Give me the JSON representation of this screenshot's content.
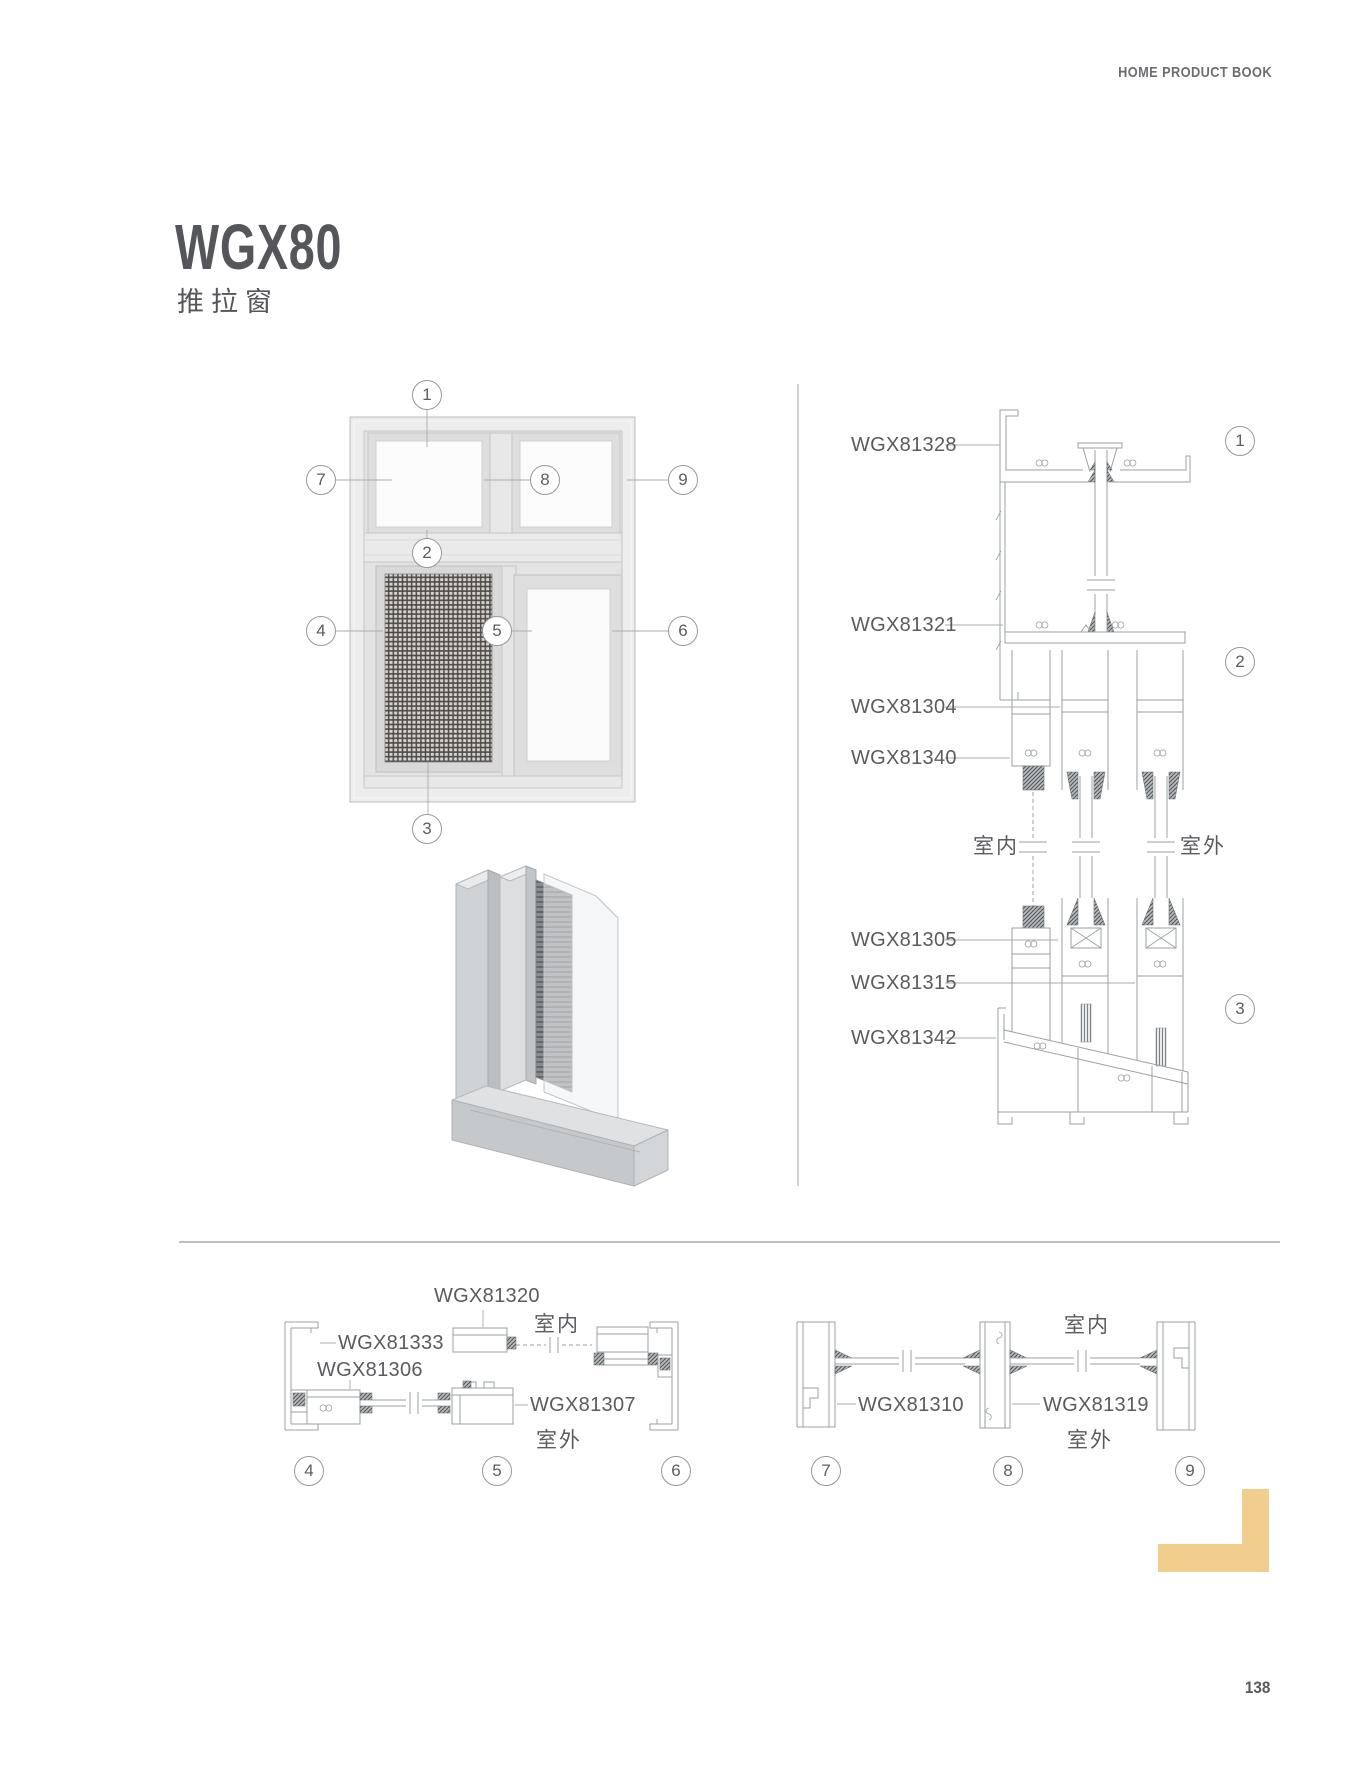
{
  "header": {
    "book_title": "HOME PRODUCT BOOK"
  },
  "product": {
    "model": "WGX80",
    "category_cn": "推拉窗"
  },
  "rooms": {
    "indoor": "室内",
    "outdoor": "室外"
  },
  "elevation": {
    "callouts": [
      "1",
      "7",
      "8",
      "9",
      "2",
      "4",
      "5",
      "6",
      "3"
    ]
  },
  "vertical_section": {
    "parts": [
      "WGX81328",
      "WGX81321",
      "WGX81304",
      "WGX81340",
      "WGX81305",
      "WGX81315",
      "WGX81342"
    ],
    "callouts": [
      "1",
      "2",
      "3"
    ]
  },
  "horizontal_section_left": {
    "parts": [
      "WGX81320",
      "WGX81333",
      "WGX81306",
      "WGX81307"
    ],
    "callouts": [
      "4",
      "5",
      "6"
    ]
  },
  "horizontal_section_right": {
    "parts": [
      "WGX81310",
      "WGX81319"
    ],
    "callouts": [
      "7",
      "8",
      "9"
    ]
  },
  "footer": {
    "page_number": "138"
  },
  "accent_color": "#F1CE8E"
}
